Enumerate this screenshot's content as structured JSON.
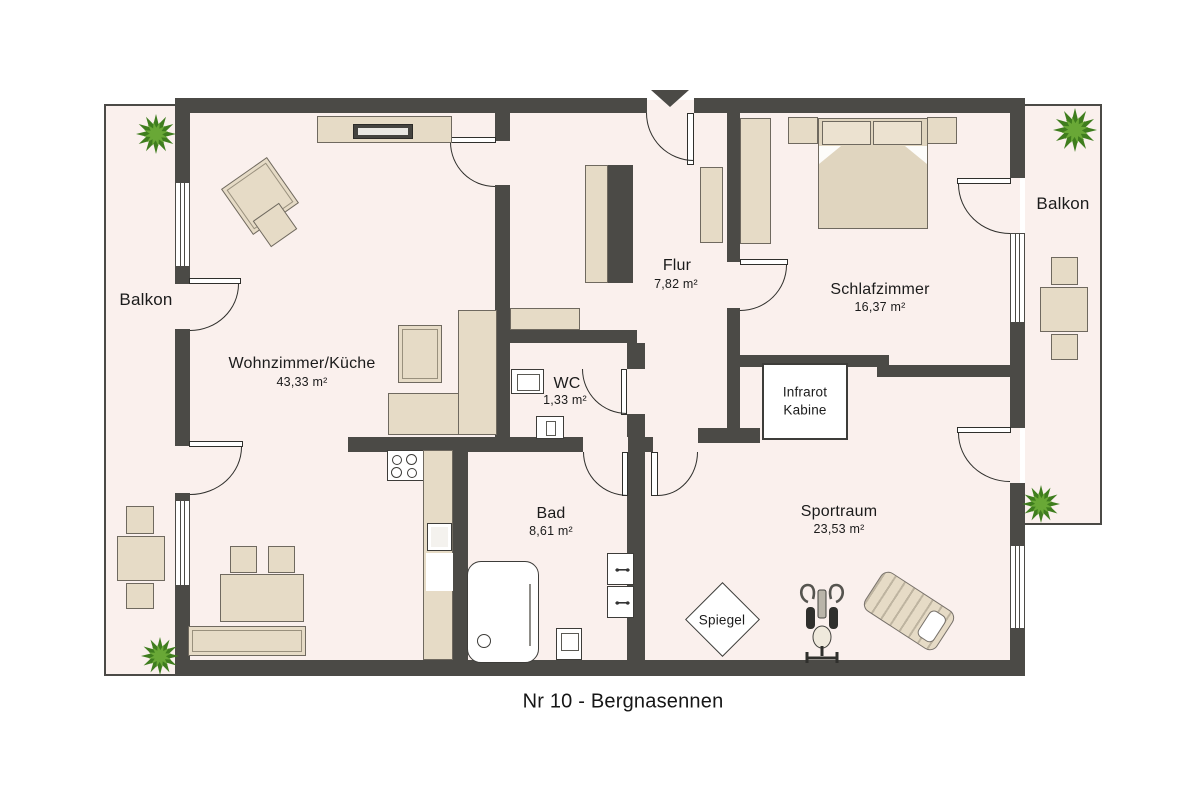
{
  "title": "Nr 10 - Bergnasennen",
  "rooms": {
    "wohnzimmer": {
      "label": "Wohnzimmer/Küche",
      "area": "43,33 m²"
    },
    "flur": {
      "label": "Flur",
      "area": "7,82 m²"
    },
    "wc": {
      "label": "WC",
      "area": "1,33 m²"
    },
    "schlafzimmer": {
      "label": "Schlafzimmer",
      "area": "16,37 m²"
    },
    "bad": {
      "label": "Bad",
      "area": "8,61 m²"
    },
    "sportraum": {
      "label": "Sportraum",
      "area": "23,53 m²"
    }
  },
  "balconies": {
    "left": {
      "label": "Balkon"
    },
    "right": {
      "label": "Balkon"
    }
  },
  "features": {
    "infrarot_kabine": {
      "line1": "Infrarot",
      "line2": "Kabine"
    },
    "spiegel": {
      "label": "Spiegel"
    }
  },
  "colors": {
    "wall": "#4b4a46",
    "floor": "#faf0ed",
    "furniture": "#e6dbc6",
    "plant_dark": "#3f7d1e",
    "plant_light": "#69a836"
  }
}
